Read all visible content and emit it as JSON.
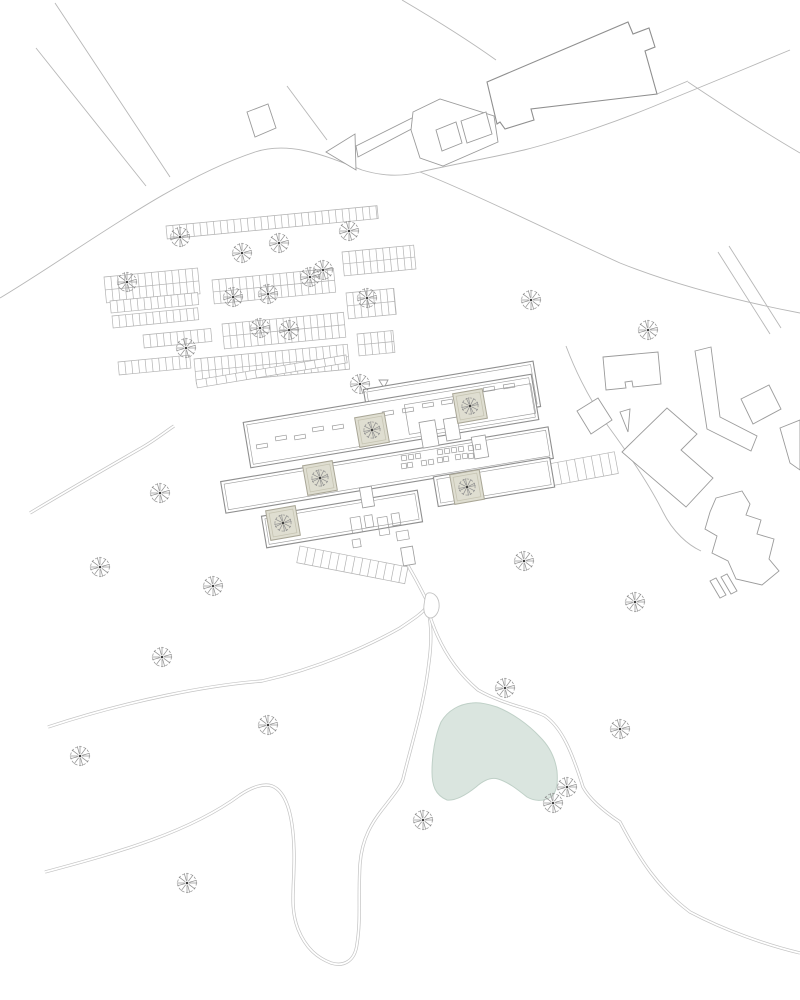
{
  "canvas": {
    "width": 800,
    "height": 1000,
    "background": "#ffffff"
  },
  "colors": {
    "road_line": "#b7b7b7",
    "path_edge": "#c3c3c3",
    "parking_line": "#b3b3b3",
    "building_line": "#9b9b9b",
    "building_dark": "#8f8f8f",
    "building_fill": "#ffffff",
    "pond_fill": "#dae5df",
    "pond_stroke": "#bfd0c7",
    "courtyard_fill": "#dfded1",
    "courtyard_stroke": "#a9a696",
    "courtyard_inner": "#c6c4b2",
    "tree_stroke": "#8f8f8f",
    "tree_center": "#404040"
  },
  "roads_single": [
    {
      "name": "nw-road-edge-a",
      "d": "M55 3 L170 177"
    },
    {
      "name": "nw-road-edge-b",
      "d": "M36 48 L146 186"
    },
    {
      "name": "main-arc-road",
      "d": "M0 298 C80 250 170 180 255 152 C292 140 330 158 362 170 C382 176 400 177 420 172 C450 165 490 158 524 150 C560 141 610 124 652 107 L742 70 L790 50"
    },
    {
      "name": "nw-building-road",
      "d": "M402 0 C436 20 468 40 496 60"
    },
    {
      "name": "square-arrow-link-road",
      "d": "M287 86 L327 140"
    },
    {
      "name": "east-sweep-road",
      "d": "M420 172 C480 196 560 236 620 263 C680 287 748 303 800 313"
    },
    {
      "name": "ne-road",
      "d": "M688 82 C724 106 762 131 800 153"
    },
    {
      "name": "building-east-link",
      "d": "M657 94 L688 81"
    },
    {
      "name": "right-road-pair-a",
      "d": "M718 252 L770 334"
    },
    {
      "name": "right-road-pair-b",
      "d": "M729 246 L781 328"
    },
    {
      "name": "midright-road",
      "d": "M566 346 C578 378 592 403 608 426 C630 456 650 486 663 512 C673 532 688 545 701 551"
    }
  ],
  "roads_double": [
    {
      "name": "west-upper-path",
      "d": "M48 727 C130 700 210 685 262 681 C320 668 370 645 400 628 C415 618 424 612 427 606"
    },
    {
      "name": "hairpin-path",
      "d": "M45 872 C120 852 190 832 240 795 C252 787 264 783 272 786 C285 791 293 812 294 850 C295 885 289 906 298 929 C306 949 318 958 331 963 C344 967 355 961 357 944 C361 919 358 899 360 864 C362 838 372 822 385 806 C395 793 401 786 403 779 C412 742 424 706 429 662 C432 640 431 620 427 606"
    },
    {
      "name": "pond-east-path",
      "d": "M427 606 C436 640 452 668 478 690 C504 705 530 708 545 716 C562 728 572 752 583 787 C590 800 605 812 620 822 C640 860 658 888 690 912 C724 930 766 945 800 953"
    },
    {
      "name": "southwest-path",
      "d": "M30 513 C70 489 110 466 143 447 C155 440 165 432 174 426"
    },
    {
      "name": "complex-south-path",
      "d": "M407 564 C416 579 423 593 427 601"
    }
  ],
  "outlines": [
    {
      "name": "north-building",
      "d": "M487 82 L628 22 L633 34 L649 28 L655 47 L645 51 L657 94 L531 109 L534 120 L505 129 L500 122 L497 124 Z",
      "stroke": "dark"
    },
    {
      "name": "small-square-building",
      "d": "M247 112 L268 104 L276 128 L255 137 Z",
      "stroke": "line"
    },
    {
      "name": "road-arrow-head",
      "d": "M326 152 L355 134 L356 170 Z",
      "stroke": "line"
    },
    {
      "name": "road-arrow-tail",
      "d": "M356 146 L418 115 L421 124 L358 157 Z",
      "stroke": "line"
    },
    {
      "name": "road-pocket",
      "d": "M413 112 L440 99 L494 116 L498 142 L443 166 L420 158 L411 130 Z",
      "stroke": "line"
    },
    {
      "name": "east-building-rect",
      "d": "M603 357 L658 352 L661 384 L633 387 L632 381 L625 382 L626 388 L606 390 Z",
      "stroke": "line"
    },
    {
      "name": "east-diamond-building",
      "d": "M577 411 L598 398 L612 420 L591 434 Z",
      "stroke": "line"
    },
    {
      "name": "east-wedge",
      "d": "M620 412 L630 409 L628 432 Z",
      "stroke": "line"
    },
    {
      "name": "east-l-building",
      "d": "M628 446 L667 408 L697 434 L681 450 L713 478 L686 507 L622 452 Z",
      "stroke": "line"
    },
    {
      "name": "east-slab-building",
      "d": "M695 351 L711 347 L720 417 L757 436 L751 451 L707 429 Z",
      "stroke": "line"
    },
    {
      "name": "east-tilt-rect",
      "d": "M741 399 L769 385 L781 409 L753 424 Z",
      "stroke": "line"
    },
    {
      "name": "east-edge-fragment",
      "d": "M780 428 L800 420 L800 470 L790 463 Z",
      "stroke": "line"
    },
    {
      "name": "southeast-blob",
      "d": "M716 498 L742 491 L750 504 L746 515 L761 520 L757 534 L774 539 L769 559 L779 571 L762 585 L736 579 L728 561 L712 553 L717 536 L705 529 L710 512 Z",
      "stroke": "line"
    },
    {
      "name": "southeast-bar-a",
      "d": "M710 581 L716 578 L726 595 L720 598 Z",
      "stroke": "line"
    },
    {
      "name": "southeast-bar-b",
      "d": "M721 577 L727 574 L737 591 L731 594 Z",
      "stroke": "line"
    },
    {
      "name": "pocket-stall-a",
      "d": "M436 130 L456 122 L462 143 L442 151 Z",
      "stroke": "line"
    },
    {
      "name": "pocket-stall-b",
      "d": "M461 121 L486 112 L492 134 L467 143 Z",
      "stroke": "line"
    },
    {
      "name": "marker-triangle",
      "d": "M379 380 L388 380 L384 388 Z",
      "stroke": "line"
    }
  ],
  "complex": {
    "rotation": -9.5,
    "bars": [
      {
        "name": "bar-north",
        "cx": 452,
        "cy": 398,
        "w": 172,
        "h": 46
      },
      {
        "name": "bar-main",
        "cx": 391,
        "cy": 421,
        "w": 292,
        "h": 46
      },
      {
        "name": "bar-middle",
        "cx": 387,
        "cy": 470,
        "w": 332,
        "h": 32
      },
      {
        "name": "bar-middle-east",
        "cx": 494,
        "cy": 482,
        "w": 118,
        "h": 30
      },
      {
        "name": "bar-south",
        "cx": 342,
        "cy": 519,
        "w": 158,
        "h": 32
      }
    ],
    "features": [
      {
        "name": "bar-main-inner-hall",
        "cx": 470,
        "cy": 409,
        "w": 128,
        "h": 30
      }
    ],
    "connectors": [
      [
        429,
        434,
        16,
        26
      ],
      [
        452,
        429,
        14,
        22
      ],
      [
        480,
        447,
        14,
        22
      ],
      [
        367,
        497,
        12,
        20
      ],
      [
        408,
        556,
        12,
        18
      ]
    ],
    "dashes": [
      [
        388,
        413
      ],
      [
        408,
        410
      ],
      [
        428,
        405
      ],
      [
        447,
        402
      ],
      [
        489,
        389
      ],
      [
        509,
        386
      ],
      [
        262,
        446
      ],
      [
        281,
        438
      ],
      [
        300,
        437
      ],
      [
        318,
        429
      ],
      [
        338,
        427
      ]
    ],
    "furniture": [
      [
        404,
        458
      ],
      [
        411,
        457
      ],
      [
        418,
        456
      ],
      [
        404,
        466
      ],
      [
        410,
        465
      ],
      [
        424,
        463
      ],
      [
        431,
        462
      ],
      [
        440,
        452
      ],
      [
        447,
        451
      ],
      [
        454,
        450
      ],
      [
        461,
        449
      ],
      [
        440,
        460
      ],
      [
        446,
        459
      ],
      [
        458,
        457
      ],
      [
        465,
        456
      ],
      [
        471,
        448
      ],
      [
        478,
        447
      ],
      [
        471,
        456
      ]
    ],
    "rooms": [
      [
        350,
        518,
        10,
        16
      ],
      [
        364,
        516,
        8,
        12
      ],
      [
        377,
        518,
        10,
        18
      ],
      [
        391,
        514,
        8,
        12
      ],
      [
        396,
        532,
        12,
        9
      ],
      [
        352,
        540,
        8,
        8
      ]
    ]
  },
  "courtyards": {
    "size": 30,
    "rotation": -10,
    "centers": [
      [
        372,
        430
      ],
      [
        470,
        406
      ],
      [
        320,
        478
      ],
      [
        467,
        487
      ],
      [
        283,
        523
      ]
    ]
  },
  "parking": {
    "rotation": -5.5,
    "pitch": 6.8,
    "rows": [
      [
        166,
        226,
        212,
        13,
        false
      ],
      [
        104,
        277,
        94,
        26,
        true
      ],
      [
        212,
        280,
        122,
        24,
        true
      ],
      [
        342,
        252,
        72,
        24,
        true
      ],
      [
        346,
        293,
        48,
        26,
        true
      ],
      [
        110,
        301,
        88,
        12,
        false
      ],
      [
        112,
        316,
        86,
        12,
        false
      ],
      [
        143,
        335,
        68,
        13,
        false
      ],
      [
        222,
        324,
        122,
        25,
        true
      ],
      [
        118,
        362,
        72,
        13,
        false
      ],
      [
        194,
        359,
        154,
        25,
        true
      ],
      [
        357,
        334,
        36,
        22,
        true
      ]
    ]
  },
  "strips": [
    {
      "name": "platform-canopy",
      "x": 196,
      "y": 380,
      "len": 152,
      "depth": 8,
      "rot": -9.5,
      "pitch": 10
    },
    {
      "name": "stair-ramp",
      "x": 300,
      "y": 546,
      "len": 110,
      "depth": 17,
      "rot": 11,
      "pitch": 8
    },
    {
      "name": "east-parking-strip",
      "x": 516,
      "y": 470,
      "len": 100,
      "depth": 22,
      "rot": -10.5,
      "pitch": 8.5
    }
  ],
  "pond": {
    "d": "M472 703 C460 704 448 710 441 722 C435 736 432 755 432 772 C432 785 435 795 447 800 C456 801 466 795 476 787 C484 780 491 777 498 779 C508 782 517 789 527 797 C534 801 543 802 551 797 C557 792 558 783 557 771 C555 757 549 746 540 737 C528 724 512 713 497 707 C488 704 479 702 472 703 Z"
  },
  "teardrop": {
    "d": "M428 593 C433 592 438 596 439 603 C440 611 436 617 431 618 C426 618 423 613 424 605 C425 599 425 594 428 593 Z"
  },
  "trees": {
    "radius": 11,
    "positions": [
      [
        180,
        237
      ],
      [
        279,
        243
      ],
      [
        242,
        253
      ],
      [
        349,
        231
      ],
      [
        323,
        270
      ],
      [
        127,
        282
      ],
      [
        310,
        277
      ],
      [
        268,
        294
      ],
      [
        233,
        297
      ],
      [
        367,
        298
      ],
      [
        260,
        328
      ],
      [
        289,
        330
      ],
      [
        186,
        348
      ],
      [
        360,
        384
      ],
      [
        531,
        300
      ],
      [
        648,
        330
      ],
      [
        160,
        493
      ],
      [
        100,
        567
      ],
      [
        213,
        586
      ],
      [
        524,
        561
      ],
      [
        635,
        602
      ],
      [
        162,
        657
      ],
      [
        80,
        756
      ],
      [
        268,
        725
      ],
      [
        505,
        688
      ],
      [
        620,
        729
      ],
      [
        553,
        803
      ],
      [
        567,
        787
      ],
      [
        423,
        820
      ],
      [
        187,
        883
      ]
    ]
  }
}
